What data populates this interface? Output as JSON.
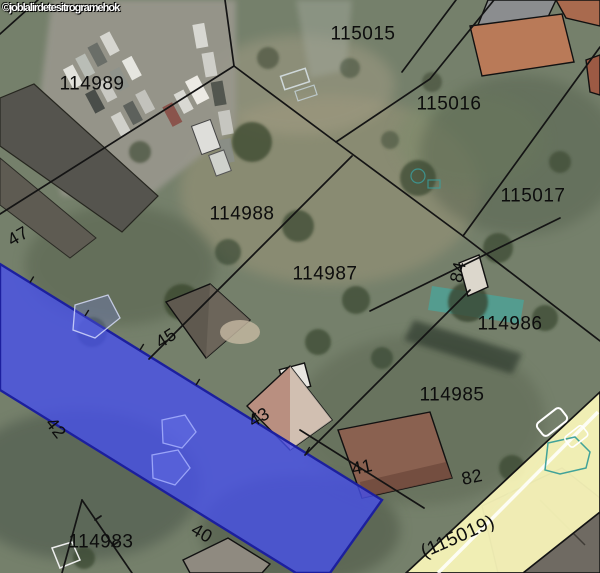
{
  "map": {
    "watermark": "©joblalirdetesitrogramehok",
    "parcel_labels": [
      {
        "text": "115015",
        "x": 363,
        "y": 34,
        "rot": 0
      },
      {
        "text": "115016",
        "x": 449,
        "y": 104,
        "rot": 0
      },
      {
        "text": "115017",
        "x": 533,
        "y": 196,
        "rot": 0
      },
      {
        "text": "114989",
        "x": 92,
        "y": 84,
        "rot": 0
      },
      {
        "text": "114988",
        "x": 242,
        "y": 214,
        "rot": 0
      },
      {
        "text": "114987",
        "x": 325,
        "y": 274,
        "rot": 0
      },
      {
        "text": "114986",
        "x": 510,
        "y": 324,
        "rot": 0
      },
      {
        "text": "114985",
        "x": 452,
        "y": 395,
        "rot": 0
      },
      {
        "text": "114983",
        "x": 101,
        "y": 542,
        "rot": 0
      },
      {
        "text": "(115019)",
        "x": 458,
        "y": 537,
        "rot": -24
      }
    ],
    "house_numbers": [
      {
        "text": "47",
        "x": 18,
        "y": 236,
        "rot": -30
      },
      {
        "text": "45",
        "x": 166,
        "y": 338,
        "rot": -33
      },
      {
        "text": "43",
        "x": 259,
        "y": 417,
        "rot": -30
      },
      {
        "text": "41",
        "x": 362,
        "y": 467,
        "rot": -12
      },
      {
        "text": "42",
        "x": 56,
        "y": 428,
        "rot": 52
      },
      {
        "text": "40",
        "x": 202,
        "y": 533,
        "rot": 30
      },
      {
        "text": "82",
        "x": 472,
        "y": 477,
        "rot": -12
      },
      {
        "text": "84",
        "x": 458,
        "y": 272,
        "rot": -78
      }
    ],
    "colors": {
      "selected_parcel_fill": "#4650ee",
      "selected_parcel_border": "#1c1f9e",
      "road_parcel_fill": "#f7f3b8",
      "boundary_line": "#141414",
      "pool": "#4fa195",
      "label_color": "#0d0d0d"
    }
  }
}
